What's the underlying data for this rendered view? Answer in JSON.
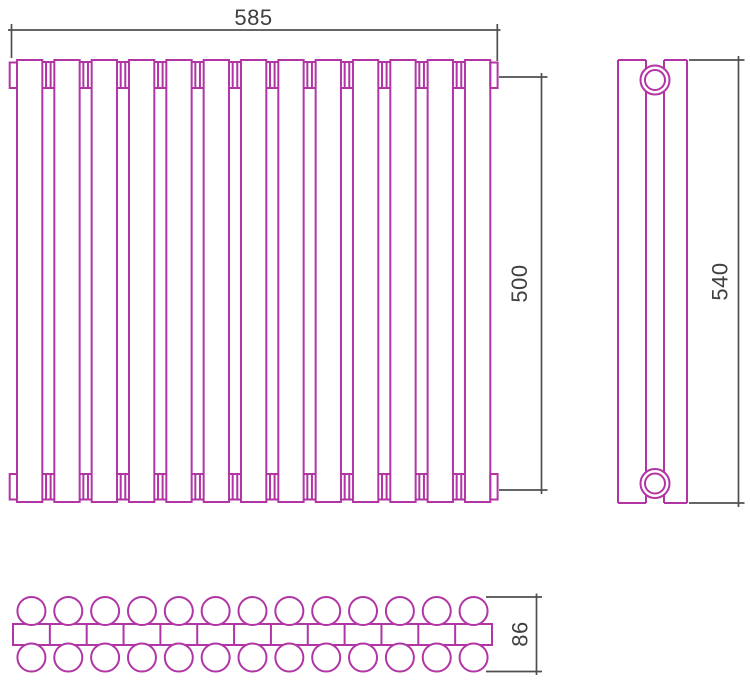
{
  "page": {
    "background": "#ffffff"
  },
  "drawing": {
    "kind": "technical-three-view-drawing",
    "subject": "sectional tubular radiator",
    "colors": {
      "outline": "#b135a5",
      "dimension_line": "#4f4f4f",
      "dimension_text": "#404040"
    },
    "front_view": {
      "sections": 13,
      "section_gaps": 12,
      "collector_end_caps": 4
    },
    "side_view": {
      "connection_ports": 2
    },
    "top_view": {
      "rows_of_tubes": 2,
      "tubes_per_row": 13
    },
    "dimensions": {
      "width": {
        "label": "585"
      },
      "port_axial_height": {
        "label": "500"
      },
      "overall_height": {
        "label": "540"
      },
      "depth": {
        "label": "86"
      }
    }
  }
}
